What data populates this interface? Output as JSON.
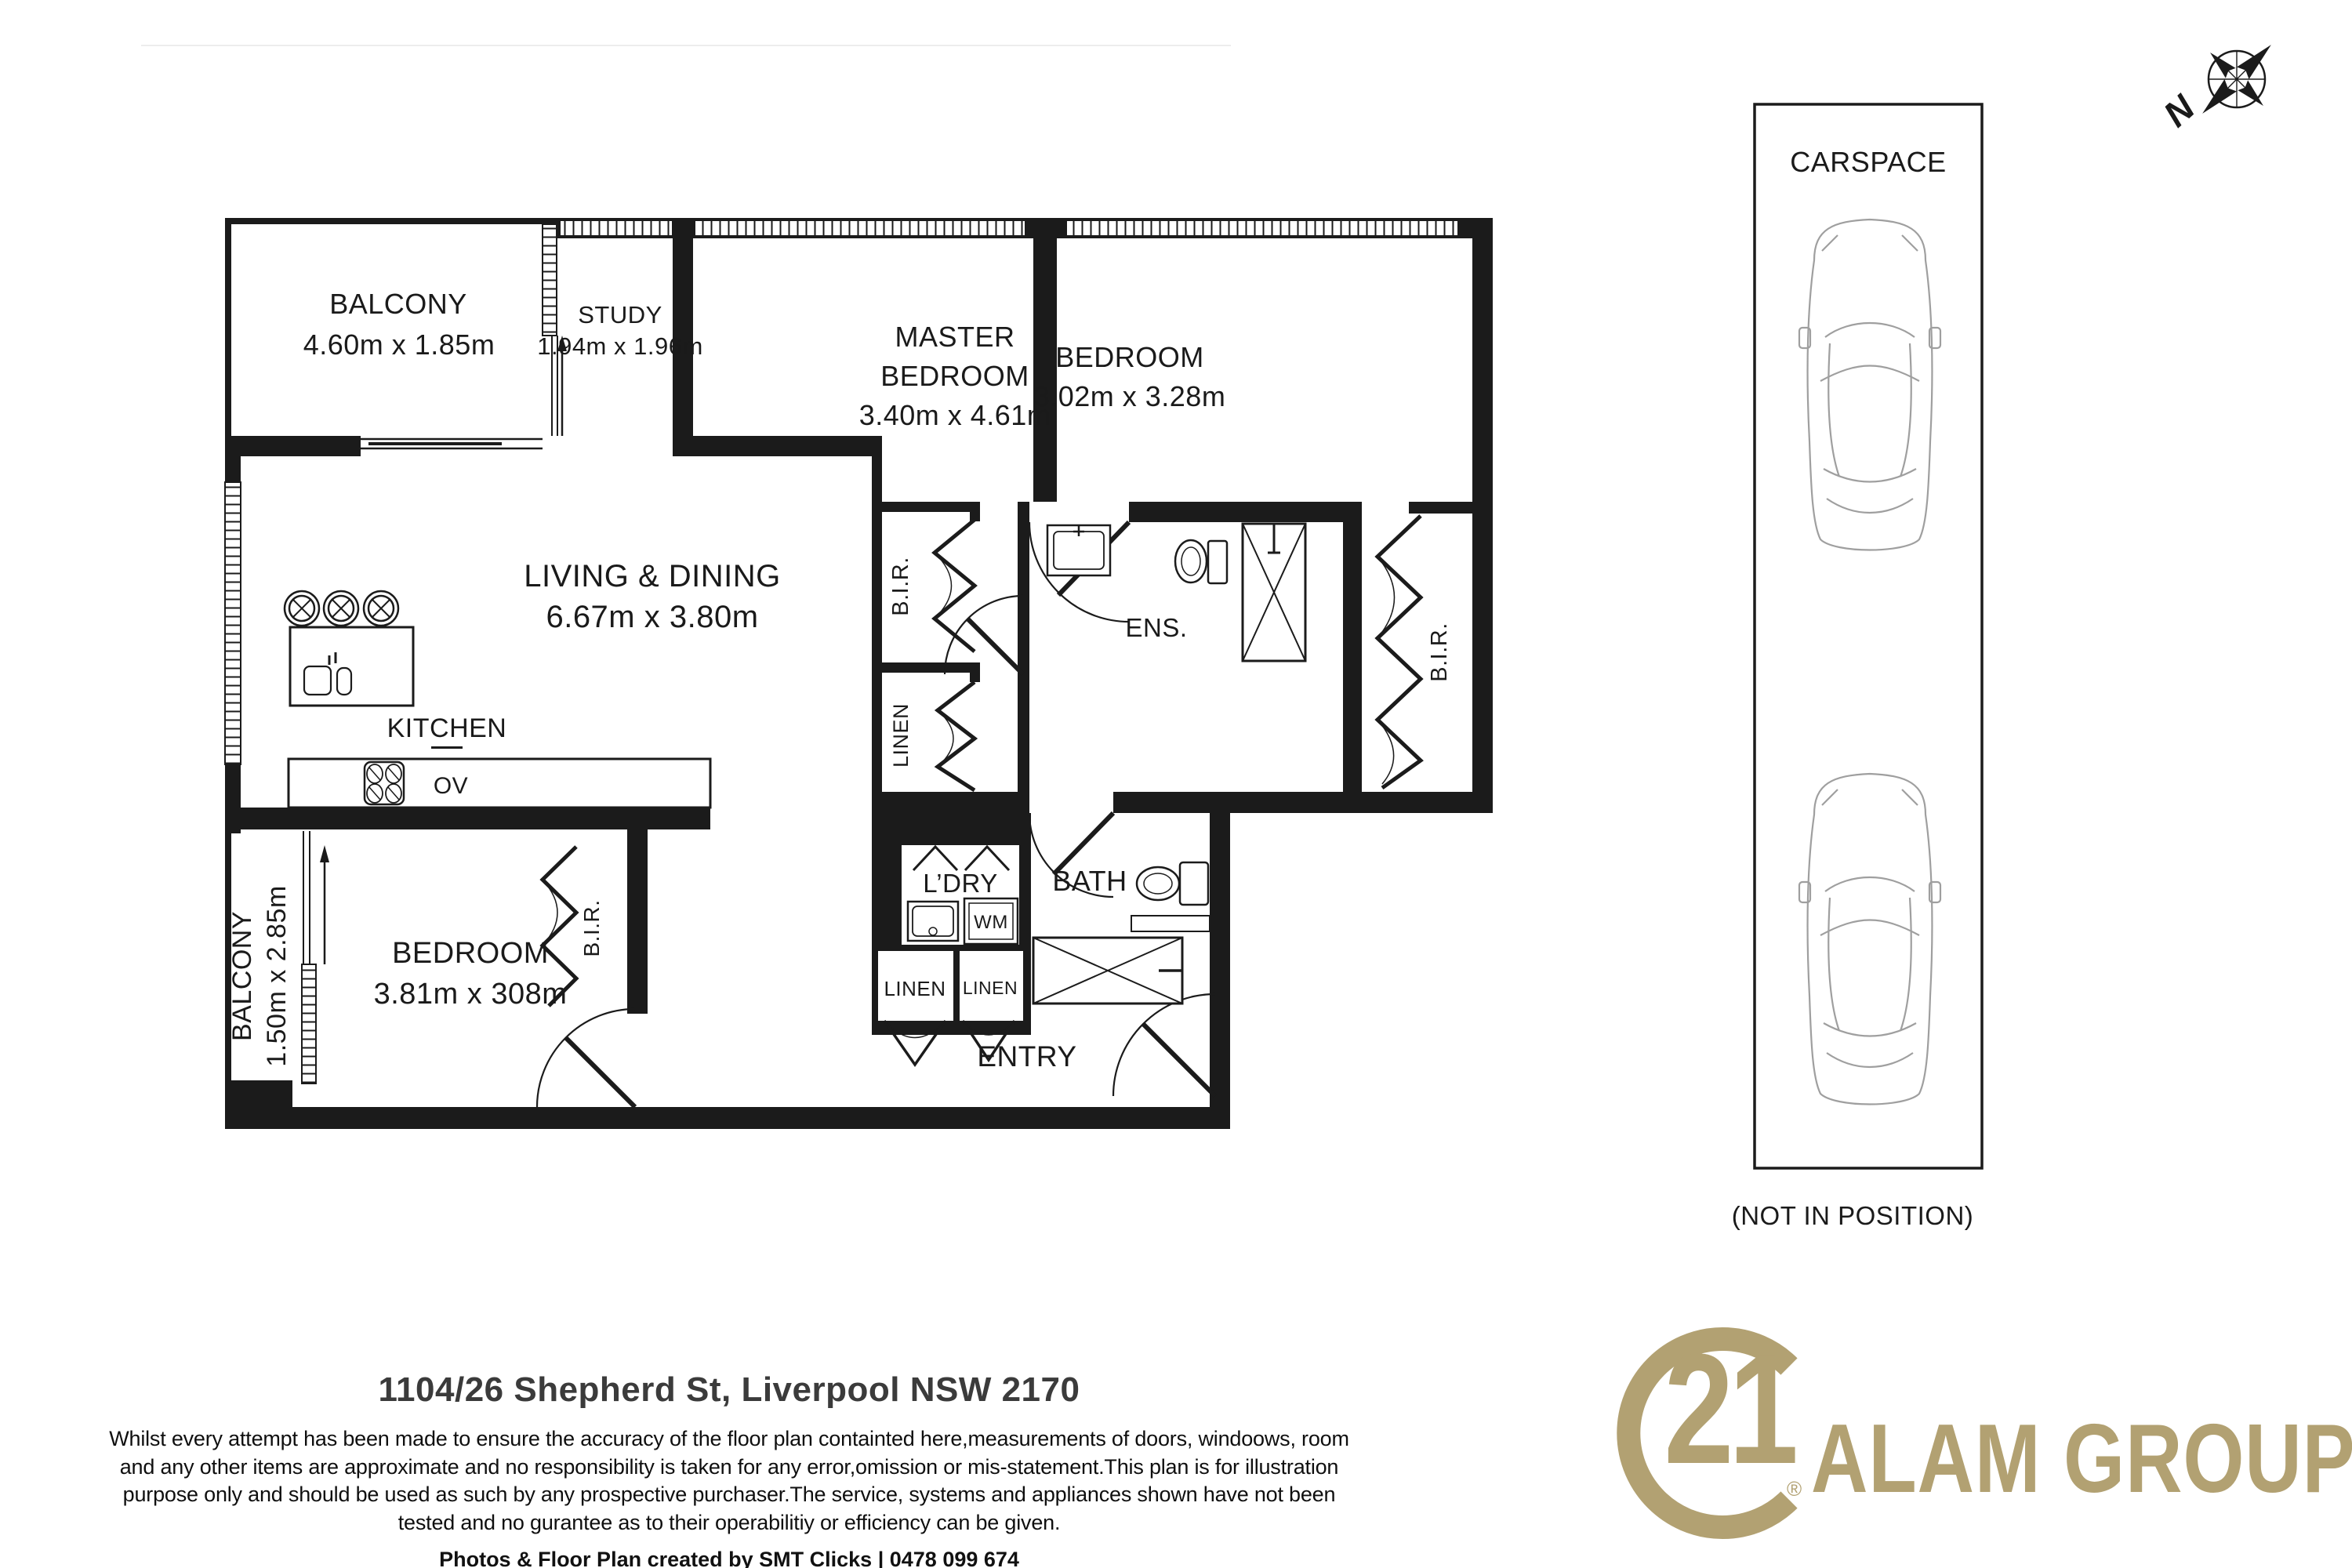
{
  "plan": {
    "balcony_top": {
      "name": "BALCONY",
      "dims": "4.60m x 1.85m"
    },
    "study": {
      "name": "STUDY",
      "dims": "1.94m x 1.96m"
    },
    "master": {
      "line1": "MASTER",
      "line2": "BEDROOM",
      "dims": "3.40m x 4.61m"
    },
    "bedroom2": {
      "name": "BEDROOM",
      "dims": "3.02m x 3.28m"
    },
    "living": {
      "name": "LIVING & DINING",
      "dims": "6.67m x 3.80m"
    },
    "kitchen": {
      "name": "KITCHEN",
      "ov": "OV"
    },
    "bedroom3": {
      "name": "BEDROOM",
      "dims": "3.81m x 308m"
    },
    "balcony_side": {
      "name": "BALCONY",
      "dims": "1.50m x 2.85m"
    },
    "ens": {
      "name": "ENS."
    },
    "bath": {
      "name": "BATH"
    },
    "ldry": {
      "name": "L’DRY",
      "wm": "WM"
    },
    "linen": {
      "name": "LINEN"
    },
    "bir": {
      "name": "B.I.R."
    },
    "entry": {
      "name": "ENTRY"
    },
    "compass_north": "N"
  },
  "carspace": {
    "label": "CARSPACE",
    "note": "(NOT IN POSITION)"
  },
  "footer": {
    "address": "1104/26 Shepherd St, Liverpool NSW 2170",
    "disclaimer": [
      "Whilst every attempt has been made to ensure the accuracy of the floor plan containted here,measurements of doors, windoows, room",
      "and any other items are approximate and no responsibility is taken for any error,omission or mis-statement.This plan is for illustration",
      "purpose only and should be used as such by any prospective purchaser.The service, systems and appliances shown have not been",
      "tested and no gurantee as to their operabilitiy or efficiency can be given."
    ],
    "credit": "Photos & Floor Plan created by SMT Clicks | 0478 099 674"
  },
  "branding": {
    "c21_number": "21",
    "registered": "®",
    "group_name": "ALAM GROUP",
    "gold": "#b2a172"
  }
}
